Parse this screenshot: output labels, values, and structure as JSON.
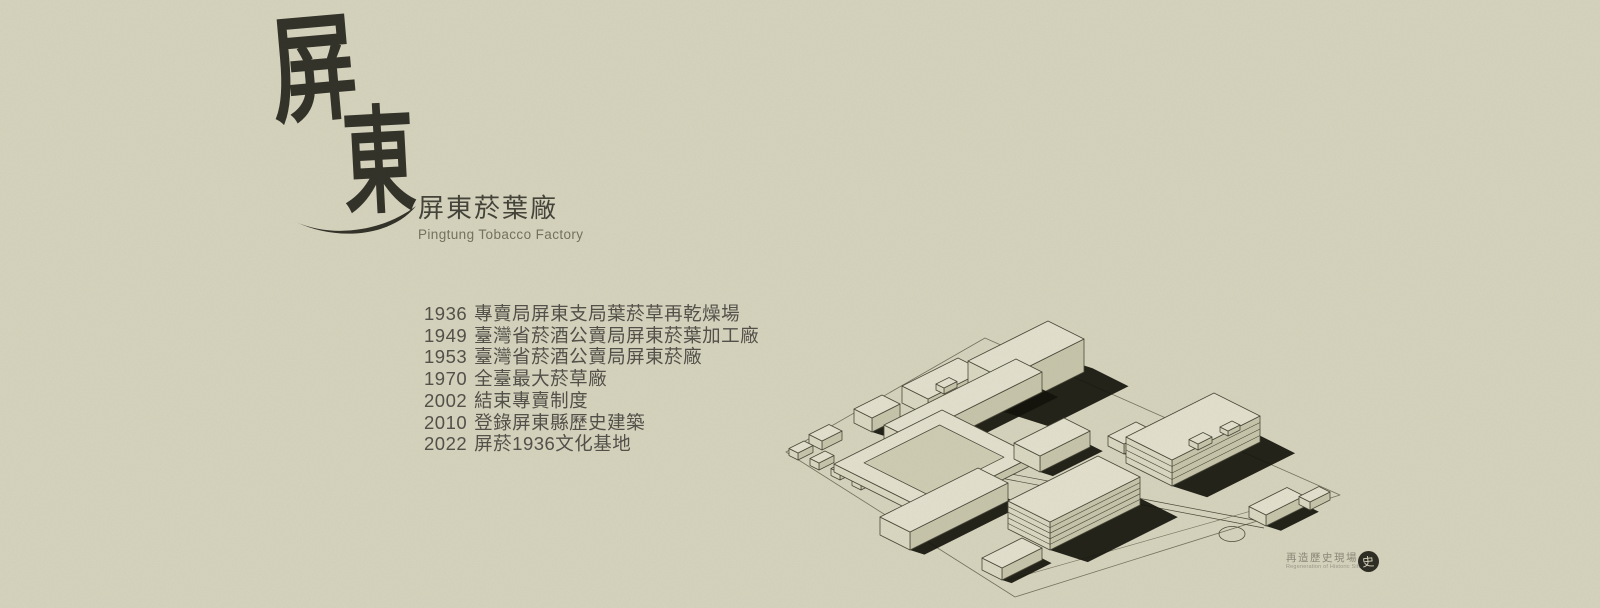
{
  "page": {
    "kind": "heritage-site banner poster",
    "colors": {
      "paper": "#d6d4bd",
      "ink": "#403f33",
      "drawing_shadow": "#14140c"
    }
  },
  "logo": {
    "char_top": "屏",
    "char_bottom": "東"
  },
  "title": {
    "zh": "屏東菸葉廠",
    "en": "Pingtung Tobacco Factory"
  },
  "timeline": {
    "items": [
      {
        "year": "1936",
        "event": "專賣局屏東支局葉菸草再乾燥場"
      },
      {
        "year": "1949",
        "event": "臺灣省菸酒公賣局屏東菸葉加工廠"
      },
      {
        "year": "1953",
        "event": "臺灣省菸酒公賣局屏東菸廠"
      },
      {
        "year": "1970",
        "event": "全臺最大菸草廠"
      },
      {
        "year": "2002",
        "event": "結束專賣制度"
      },
      {
        "year": "2010",
        "event": "登錄屏東縣歷史建築"
      },
      {
        "year": "2022",
        "event": "屏菸1936文化基地"
      }
    ]
  },
  "illustration": {
    "name": "factory-campus-isometric-line-drawing"
  },
  "credit": {
    "zh": "再造歷史現場",
    "en": "Regeneration of Historic Sites",
    "seal_glyph": "史"
  }
}
